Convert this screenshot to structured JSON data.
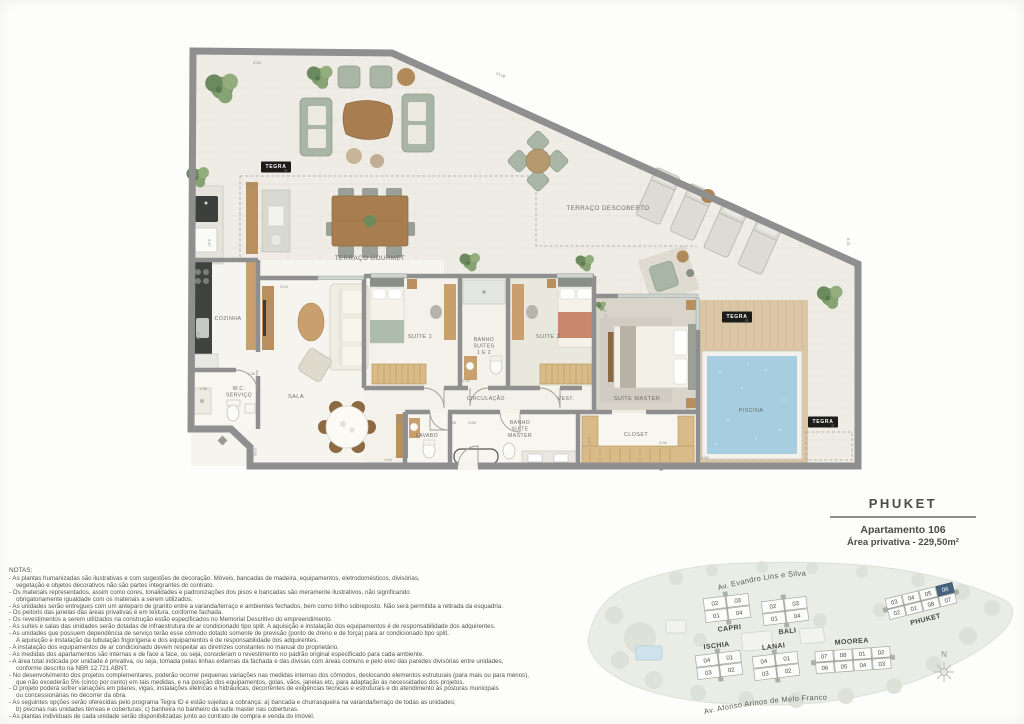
{
  "brand": {
    "name": "TEGRA",
    "program": "ID"
  },
  "title_block": {
    "building": "PHUKET",
    "apartment": "Apartamento 106",
    "area": "Área privativa - 229,50m²"
  },
  "floor_plan": {
    "room_labels": [
      {
        "lines": [
          "TERRAÇO DESCOBERTO"
        ],
        "x": 608,
        "y": 210,
        "s": 6.2
      },
      {
        "lines": [
          "TERRAÇO GOURMET"
        ],
        "x": 370,
        "y": 260,
        "s": 6.2
      },
      {
        "lines": [
          "COZINHA"
        ],
        "x": 228,
        "y": 320,
        "s": 5.3
      },
      {
        "lines": [
          "W.C.",
          "SERVIÇO"
        ],
        "x": 239,
        "y": 390,
        "s": 5.1
      },
      {
        "lines": [
          "SALA"
        ],
        "x": 296,
        "y": 398,
        "s": 5.6
      },
      {
        "lines": [
          "SUÍTE 1"
        ],
        "x": 420,
        "y": 338,
        "s": 5.6
      },
      {
        "lines": [
          "BANHO",
          "SUÍTES",
          "1 E 2"
        ],
        "x": 484,
        "y": 341,
        "s": 5.1
      },
      {
        "lines": [
          "SUÍTE 2"
        ],
        "x": 548,
        "y": 338,
        "s": 5.6
      },
      {
        "lines": [
          "CIRCULAÇÃO"
        ],
        "x": 486,
        "y": 400,
        "s": 5.1
      },
      {
        "lines": [
          "VEST."
        ],
        "x": 566,
        "y": 400,
        "s": 5.1
      },
      {
        "lines": [
          "SUÍTE MASTER"
        ],
        "x": 637,
        "y": 400,
        "s": 5.6
      },
      {
        "lines": [
          "LAVABO"
        ],
        "x": 427,
        "y": 437,
        "s": 5.1
      },
      {
        "lines": [
          "BANHO",
          "SUÍTE",
          "MASTER"
        ],
        "x": 520,
        "y": 424,
        "s": 5.1
      },
      {
        "lines": [
          "CLOSET"
        ],
        "x": 636,
        "y": 436,
        "s": 5.4
      },
      {
        "lines": [
          "PISCINA"
        ],
        "x": 751,
        "y": 412,
        "s": 5.4
      }
    ],
    "dimensions": [
      {
        "t": "5.39",
        "x": 257,
        "y": 64,
        "rot": 0
      },
      {
        "t": "13.28",
        "x": 500,
        "y": 76,
        "rot": 24
      },
      {
        "t": "8.31",
        "x": 847,
        "y": 242,
        "rot": 90
      },
      {
        "t": "1.64",
        "x": 249,
        "y": 185,
        "rot": 0
      },
      {
        "t": "5.97",
        "x": 208,
        "y": 243,
        "rot": 90
      },
      {
        "t": "3.86",
        "x": 197,
        "y": 336,
        "rot": 90
      },
      {
        "t": "3.20",
        "x": 284,
        "y": 288,
        "rot": 0
      },
      {
        "t": "1.98",
        "x": 251,
        "y": 375,
        "rot": 0
      },
      {
        "t": "1.58",
        "x": 203,
        "y": 390,
        "rot": 0
      },
      {
        "t": "5.65",
        "x": 254,
        "y": 452,
        "rot": 90
      },
      {
        "t": "2.36",
        "x": 398,
        "y": 420,
        "rot": 90
      },
      {
        "t": "4.54",
        "x": 388,
        "y": 461,
        "rot": 0
      },
      {
        "t": "1.58",
        "x": 452,
        "y": 424,
        "rot": 0
      },
      {
        "t": "3.56",
        "x": 472,
        "y": 424,
        "rot": 0
      },
      {
        "t": "2.69",
        "x": 466,
        "y": 382,
        "rot": 0
      },
      {
        "t": "2.77",
        "x": 604,
        "y": 314,
        "rot": 90
      },
      {
        "t": "3.18",
        "x": 593,
        "y": 356,
        "rot": 90
      },
      {
        "t": "2.97",
        "x": 588,
        "y": 441,
        "rot": 90
      },
      {
        "t": "3.39",
        "x": 663,
        "y": 444,
        "rot": 0
      },
      {
        "t": "4.72",
        "x": 686,
        "y": 407,
        "rot": 90
      },
      {
        "t": "4.80",
        "x": 705,
        "y": 459,
        "rot": 0
      }
    ],
    "tegra_badges": [
      {
        "x": 276,
        "y": 167
      },
      {
        "x": 737,
        "y": 317
      },
      {
        "x": 823,
        "y": 422
      }
    ]
  },
  "notes": {
    "title": "NOTAS:",
    "lines": [
      "- As plantas humanizadas são ilustrativas e com sugestões de decoração. Móveis, bancadas de madeira, equipamentos, eletrodomésticos, divisórias,",
      "vegetação e objetos decorativos não são partes integrantes do contrato.",
      "- Os materiais representados, assim como cores, tonalidades e padronizações dos pisos e bancadas são meramente ilustrativos, não significando",
      "obrigatoriamente igualdade com os materiais a serem utilizados.",
      "- As unidades serão entregues com um anteparo de granito entre a varanda/terraço e ambientes fechados, bem como trilho sobreposto. Não será permitida a retirada da esquadria.",
      "- Os peitoris das janelas das áreas privativas é em textura, conforme fachada.",
      "- Os revestimentos a serem utilizados na construção estão especificados no Memorial Descritivo do empreendimento.",
      "- As suítes e salas das unidades serão dotadas de infraestrutura de ar condicionado tipo split. A aquisição e instalação dos equipamentos é de responsabilidade dos adquirentes.",
      "- As unidades que possuem dependência de serviço terão esse cômodo dotado somente de previsão (ponto de dreno e de força) para ar condicionado tipo split.",
      "A aquisição e instalação da tubulação frigorígena e dos equipamentos é de responsabilidade dos adquirentes.",
      "- A instalação dos equipamentos de ar condicionado devem respeitar as diretrizes constantes no manual do proprietário.",
      "- As medidas dos apartamentos são internas e de face a face, ou seja, consideram o revestimento no padrão original especificado para cada ambiente.",
      "- A área total indicada por unidade é privativa, ou seja, tomada pelas linhas externas da fachada e das divisas com áreas comuns e pelo eixo das paredes divisórias entre unidades,",
      "conforme descrito na NBR 12.721 ABNT.",
      "- No desenvolvimento dos projetos complementares, poderão ocorrer pequenas variações nas medidas internas dos cômodos, deslocando elementos estruturais (para mais ou para menos),",
      "que não excederão 5% (cinco por cento) em tais medidas, e na posição dos equipamentos, golas, vãos, janelas etc, para adaptação às necessidades dos projetos.",
      "- O projeto poderá sofrer variações em pilares, vigas, instalações elétricas e hidráulicas, decorrentes de exigências técnicas e estruturais e do atendimento às posturas municipais",
      "ou concessionárias no decorrer da obra.",
      "- As seguintes opções serão oferecidas pelo programa Tegra ID e estão sujeitas a cobrança: a) bancada e churrasqueira na varanda/terraço de todas as unidades;",
      "b) piscinas nas unidades térreas e coberturas; c) banheira no banheiro da suíte master nas coberturas.",
      "- As plantas individuais de cada unidade serão disponibilizadas junto ao contrato de compra e venda do imóvel."
    ]
  },
  "site_plan": {
    "streets": [
      {
        "name": "Av. Evandro Lins e Silva"
      },
      {
        "name": "Av. Afonso Arinos de Melo Franco"
      }
    ],
    "compass_label": "N",
    "highlight_color": "#47637f",
    "buildings": [
      {
        "name": "CAPRI",
        "cx": 727,
        "cy": 608,
        "rot": -7,
        "cell_w": 23,
        "cell_h": 12.5,
        "core": "v",
        "label": "below",
        "rows": [
          [
            "02",
            "03"
          ],
          [
            "01",
            "04"
          ]
        ]
      },
      {
        "name": "BALI",
        "cx": 785,
        "cy": 611,
        "rot": -7,
        "cell_w": 23,
        "cell_h": 12.5,
        "core": "v",
        "label": "below",
        "rows": [
          [
            "02",
            "03"
          ],
          [
            "01",
            "04"
          ]
        ]
      },
      {
        "name": "ISCHIA",
        "cx": 719,
        "cy": 665,
        "rot": -7,
        "cell_w": 23,
        "cell_h": 12.5,
        "core": "v",
        "label": "above",
        "rows": [
          [
            "04",
            "01"
          ],
          [
            "03",
            "02"
          ]
        ]
      },
      {
        "name": "LANAI",
        "cx": 776,
        "cy": 666,
        "rot": -7,
        "cell_w": 23,
        "cell_h": 12.5,
        "core": "v",
        "label": "above",
        "rows": [
          [
            "04",
            "01"
          ],
          [
            "03",
            "02"
          ]
        ]
      },
      {
        "name": "MOOREA",
        "cx": 853,
        "cy": 660,
        "rot": -4,
        "cell_w": 19,
        "cell_h": 11.5,
        "core": "h",
        "label": "above",
        "rows": [
          [
            "07",
            "08",
            "01",
            "02"
          ],
          [
            "06",
            "05",
            "04",
            "03"
          ]
        ]
      },
      {
        "name": "PHUKET",
        "cx": 921,
        "cy": 601,
        "rot": -14,
        "cell_w": 17.5,
        "cell_h": 11,
        "core": "h",
        "label": "below",
        "highlight": "06",
        "rows": [
          [
            "03",
            "04",
            "05",
            "06"
          ],
          [
            "02",
            "01",
            "08",
            "07"
          ]
        ]
      }
    ]
  }
}
